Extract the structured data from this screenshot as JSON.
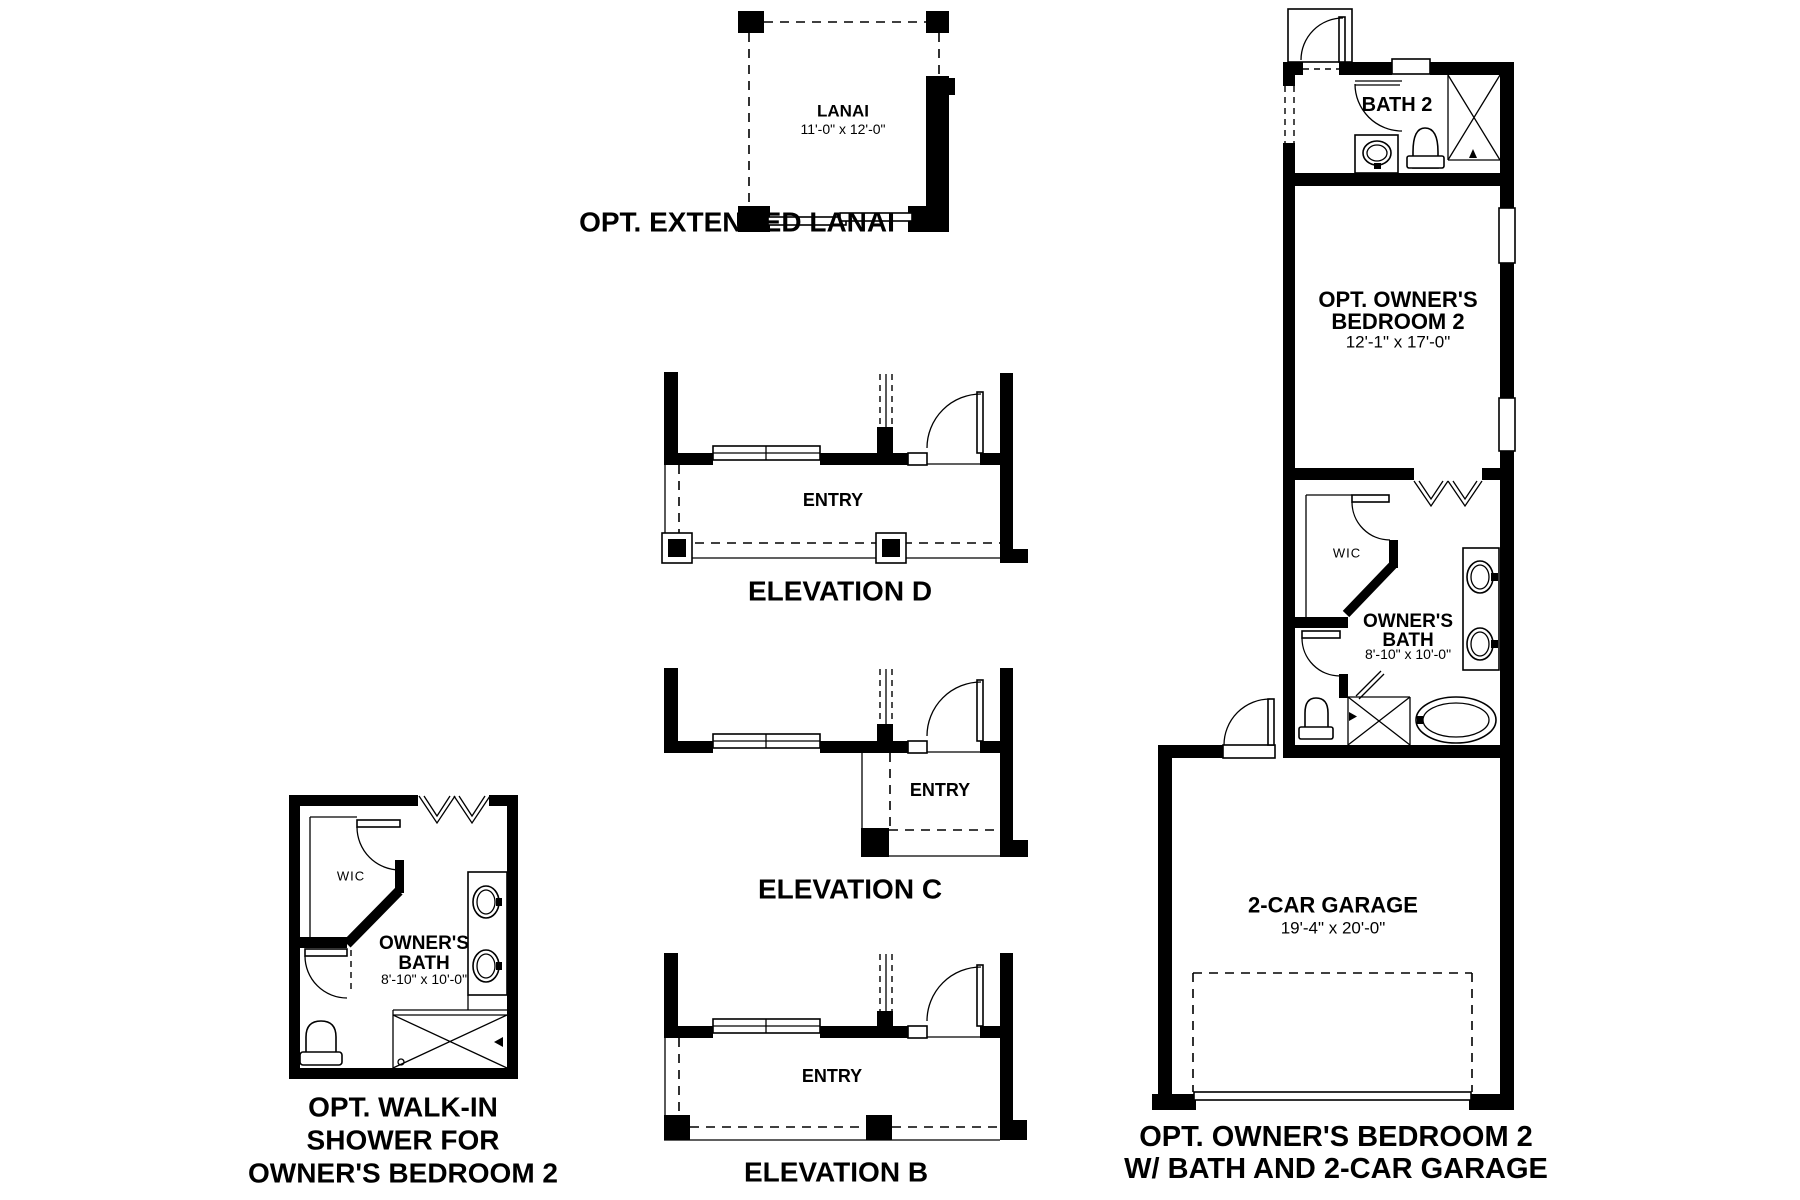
{
  "page": {
    "paper": "#ffffff",
    "ink": "#000000"
  },
  "figures": {
    "extended_lanai": {
      "caption": "OPT. EXTENDED LANAI",
      "room": {
        "name": "LANAI",
        "dims": "11'-0\" x 12'-0\""
      }
    },
    "elevation_d": {
      "caption": "ELEVATION D",
      "room": "ENTRY"
    },
    "elevation_c": {
      "caption": "ELEVATION C",
      "room": "ENTRY"
    },
    "elevation_b": {
      "caption": "ELEVATION B",
      "room": "ENTRY"
    },
    "walk_in_shower": {
      "caption": "OPT. WALK-IN\nSHOWER FOR\nOWNER'S BEDROOM 2",
      "rooms": {
        "wic": "WIC",
        "owners_bath": {
          "name": "OWNER'S\nBATH",
          "dims": "8'-10\" x 10'-0\""
        }
      }
    },
    "owners_bedroom2": {
      "caption": "OPT. OWNER'S BEDROOM 2\nW/ BATH AND 2-CAR GARAGE",
      "rooms": {
        "bath2": "BATH 2",
        "bedroom": {
          "name": "OPT. OWNER'S\nBEDROOM 2",
          "dims": "12'-1\" x 17'-0\""
        },
        "wic": "WIC",
        "owners_bath": {
          "name": "OWNER'S\nBATH",
          "dims": "8'-10\" x 10'-0\""
        },
        "garage": {
          "name": "2-CAR GARAGE",
          "dims": "19'-4\" x 20'-0\""
        }
      }
    }
  }
}
